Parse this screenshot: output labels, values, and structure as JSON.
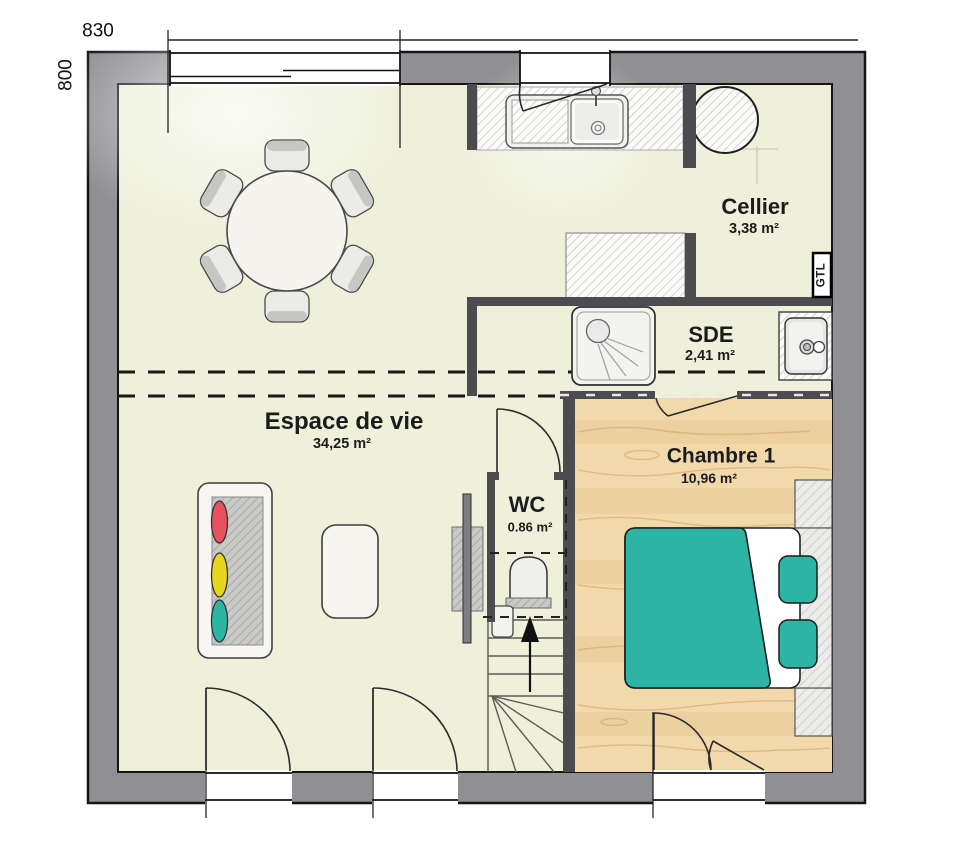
{
  "plan": {
    "dimensions": {
      "top": "830",
      "left": "800"
    },
    "rooms": {
      "living": {
        "name": "Espace de vie",
        "area": "34,25 m²"
      },
      "cellier": {
        "name": "Cellier",
        "area": "3,38 m²"
      },
      "sde": {
        "name": "SDE",
        "area": "2,41 m²"
      },
      "wc": {
        "name": "WC",
        "area": "0.86 m²"
      },
      "chambre1": {
        "name": "Chambre 1",
        "area": "10,96 m²"
      }
    },
    "annotations": {
      "gtl": "GTL"
    },
    "colors": {
      "exterior_wall": "#909094",
      "interior_wall": "#4b4b50",
      "floor_main": "#eef0da",
      "floor_wood": "#f2d9ac",
      "bed_teal": "#2cb4a4",
      "cushion_red": "#e85260",
      "cushion_yellow": "#e8d51e",
      "cushion_teal": "#2cb4a4",
      "outline": "#1a1a1a"
    },
    "furniture_icons": [
      "dining-table-icon",
      "chair-icon",
      "sofa-icon",
      "coffee-table-icon",
      "tv-unit-icon",
      "kitchen-sink-icon",
      "fridge-icon",
      "water-heater-icon",
      "shower-icon",
      "washbasin-icon",
      "double-bed-icon",
      "nightstand-icon",
      "toilet-icon",
      "stairs-icon"
    ]
  }
}
